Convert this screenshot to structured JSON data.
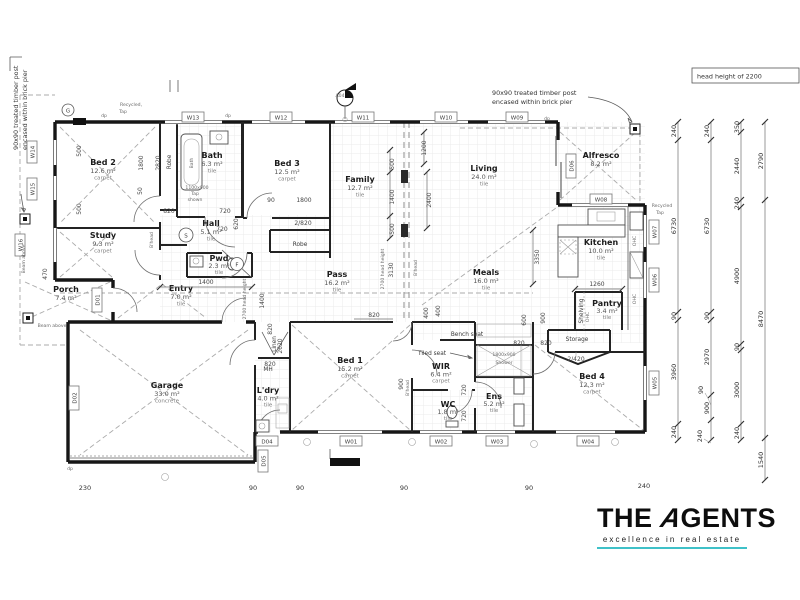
{
  "rooms": [
    {
      "name": "Bed 2",
      "area": "12.6 m²",
      "finish": "carpet"
    },
    {
      "name": "Bath",
      "area": "6.3 m²",
      "finish": "tile"
    },
    {
      "name": "Bed 3",
      "area": "12.5 m²",
      "finish": "carpet"
    },
    {
      "name": "Study",
      "area": "9.3 m²",
      "finish": "carpet"
    },
    {
      "name": "Hall",
      "area": "5.1 m²",
      "finish": "tile"
    },
    {
      "name": "Pwd",
      "area": "2.3 m²",
      "finish": "tile"
    },
    {
      "name": "Entry",
      "area": "7.0 m²",
      "finish": "tile"
    },
    {
      "name": "Porch",
      "area": "7.4 m²"
    },
    {
      "name": "Family",
      "area": "12.7 m²",
      "finish": "tile"
    },
    {
      "name": "Living",
      "area": "24.0 m²",
      "finish": "tile"
    },
    {
      "name": "Pass",
      "area": "16.2 m²",
      "finish": "tile"
    },
    {
      "name": "Meals",
      "area": "16.0 m²",
      "finish": "tile"
    },
    {
      "name": "Alfresco",
      "area": "8.2 m²"
    },
    {
      "name": "Kitchen",
      "area": "10.0 m²",
      "finish": "tile"
    },
    {
      "name": "Pantry",
      "area": "3.4 m²",
      "finish": "tile"
    },
    {
      "name": "Garage",
      "area": "33.0 m²",
      "finish": "concrete"
    },
    {
      "name": "L'dry",
      "area": "4.0 m²",
      "finish": "tile"
    },
    {
      "name": "Bed 1",
      "area": "15.2 m²",
      "finish": "carpet"
    },
    {
      "name": "WIR",
      "area": "6.4 m²",
      "finish": "carpet"
    },
    {
      "name": "WC",
      "area": "1.8 m²",
      "finish": "tile"
    },
    {
      "name": "Ens",
      "area": "5.2 m²",
      "finish": "tile"
    },
    {
      "name": "Bed 4",
      "area": "12.3 m²",
      "finish": "carpet"
    }
  ],
  "labels": [
    "Robe",
    "Robe",
    "Linen",
    "MH",
    "Bench seat",
    "Tiled seat",
    "Shelving",
    "Storage",
    "OHC",
    "OHC",
    "OHC",
    "Bath",
    "B'head",
    "B'head",
    "B'head",
    "2700 head height",
    "2700 head height",
    "1100x900",
    "Tap",
    "shown",
    "1800x900",
    "Shower"
  ],
  "dims": {
    "inner": [
      "500",
      "1800",
      "2820",
      "500",
      "50",
      "820",
      "720",
      "720",
      "620",
      "1400",
      "90",
      "1800",
      "2/820",
      "1200",
      "500",
      "1400",
      "500",
      "2400",
      "3130",
      "3350",
      "900",
      "600",
      "400",
      "1260",
      "820",
      "2/420",
      "820",
      "820",
      "2620",
      "820",
      "900",
      "400",
      "720",
      "720",
      "820",
      "470",
      "1400"
    ],
    "right1": [
      "240",
      "6730",
      "90",
      "3960",
      "240"
    ],
    "right2": [
      "240",
      "6730",
      "90",
      "2970",
      "90",
      "900",
      "240"
    ],
    "right3": [
      "350",
      "2440",
      "240",
      "4900",
      "90",
      "3000",
      "240"
    ],
    "right4": [
      "2790",
      "8470",
      "1540"
    ],
    "bottom": [
      "230",
      "90",
      "90",
      "90",
      "90",
      "240"
    ]
  },
  "tags": {
    "g": "G",
    "s": "S",
    "f": "F",
    "a04": "A04",
    "w01": "W01",
    "w02": "W02",
    "w03": "W03",
    "w04": "W04",
    "w05": "W05",
    "w06": "W06",
    "w07": "W07",
    "w08": "W08",
    "w09": "W09",
    "w10": "W10",
    "w11": "W11",
    "w12": "W12",
    "w13": "W13",
    "w14": "W14",
    "w15": "W15",
    "w16": "W16",
    "d01": "D01",
    "d02": "D02",
    "d04": "D04",
    "d05": "D05",
    "d06": "D06"
  },
  "notes": {
    "post_line1": "90x90 treated timber post",
    "post_line2": "encased within brick pier",
    "head_height": "head height of 2200",
    "recycled_top1": "Recycled,",
    "recycled_top2": "Tap",
    "recycled_right1": "Recycled",
    "recycled_right2": "Tap",
    "beam_above": "Beam above",
    "dp": "dp"
  },
  "logo": {
    "word1": "THE",
    "a": "A",
    "rest": "GENTS",
    "tagline": "excellence in real estate",
    "accent": "#3fc1c8",
    "text_color": "#0d0d0d"
  }
}
